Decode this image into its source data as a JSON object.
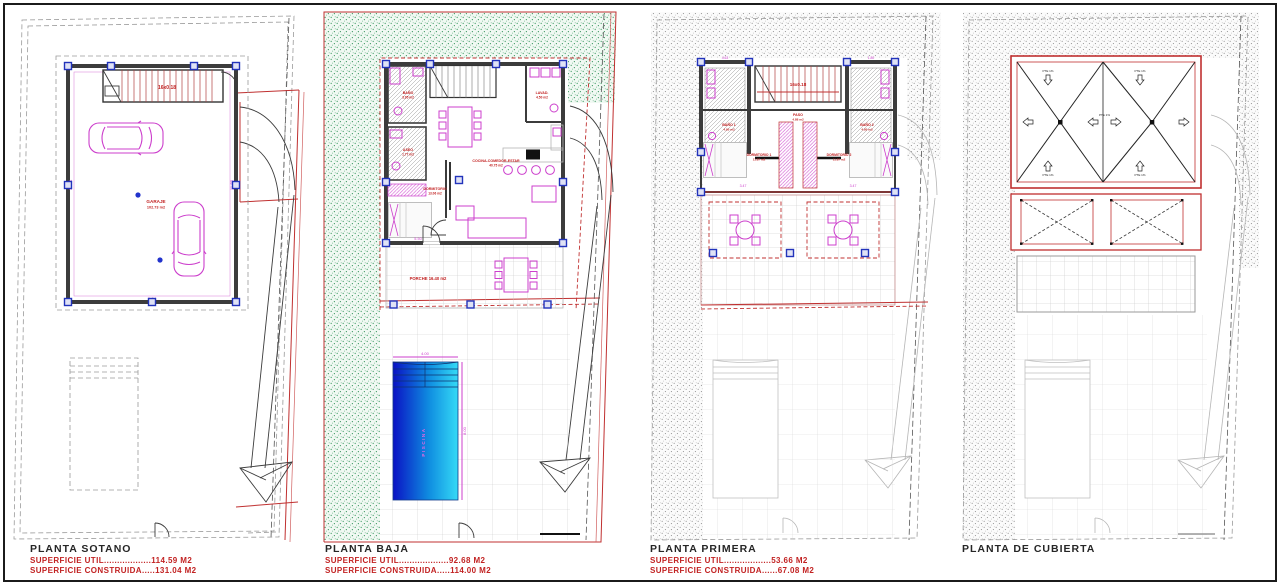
{
  "captions": [
    {
      "title": "PLANTA SOTANO",
      "util": "SUPERFICIE UTIL..................114.59 M2",
      "construida": "SUPERFICIE CONSTRUIDA.....131.04 M2"
    },
    {
      "title": "PLANTA BAJA",
      "util": "SUPERFICIE UTIL...................92.68 M2",
      "construida": "SUPERFICIE CONSTRUIDA.....114.00 M2"
    },
    {
      "title": "PLANTA PRIMERA",
      "util": "SUPERFICIE UTIL..................53.66 M2",
      "construida": "SUPERFICIE CONSTRUIDA......67.08 M2"
    },
    {
      "title": "PLANTA DE CUBIERTA",
      "util": "",
      "construida": ""
    }
  ],
  "sotano": {
    "room": "GARAJE",
    "room_area": "102.73 m2",
    "stair": "16x0.18",
    "dim_width": "8.24",
    "dim_right": "11.80",
    "dim_left": "10.74"
  },
  "baja": {
    "salon": "COCINA-COMEDOR-ESTAR",
    "salon_area": "40.75 m2",
    "dormitorio": "DORMITORIO",
    "dormitorio_area": "13.06 m2",
    "bano": "BAÑO",
    "bano_area": "3.95 m2",
    "aseo": "ASEO",
    "aseo_area": "1.77 m2",
    "lavadero": "LAVAD.",
    "lavadero_area": "4.50 m2",
    "porche": "PORCHE  16.40 m2",
    "piscina": "PISCINA",
    "dim_pool_w": "4.00",
    "dim_pool_h": "8.00",
    "dim_dorm": "5.50"
  },
  "primera": {
    "dorm1": "DORMITORIO 1",
    "dorm1_area": "11.87 m2",
    "dorm2": "DORMITORIO 2",
    "dorm2_area": "11.87 m2",
    "bano1": "BAÑO 1",
    "bano1_area": "4.95 m2",
    "bano2": "BAÑO 2",
    "bano2_area": "4.95 m2",
    "paso": "PASO",
    "paso_area": "4.88 m2",
    "stair": "16x0.18",
    "dim1": "3.47",
    "dim2": "3.47",
    "dim_t1": "4.63",
    "dim_t2": "1.80"
  },
  "cubierta": {
    "slope": "PTE 1%"
  }
}
